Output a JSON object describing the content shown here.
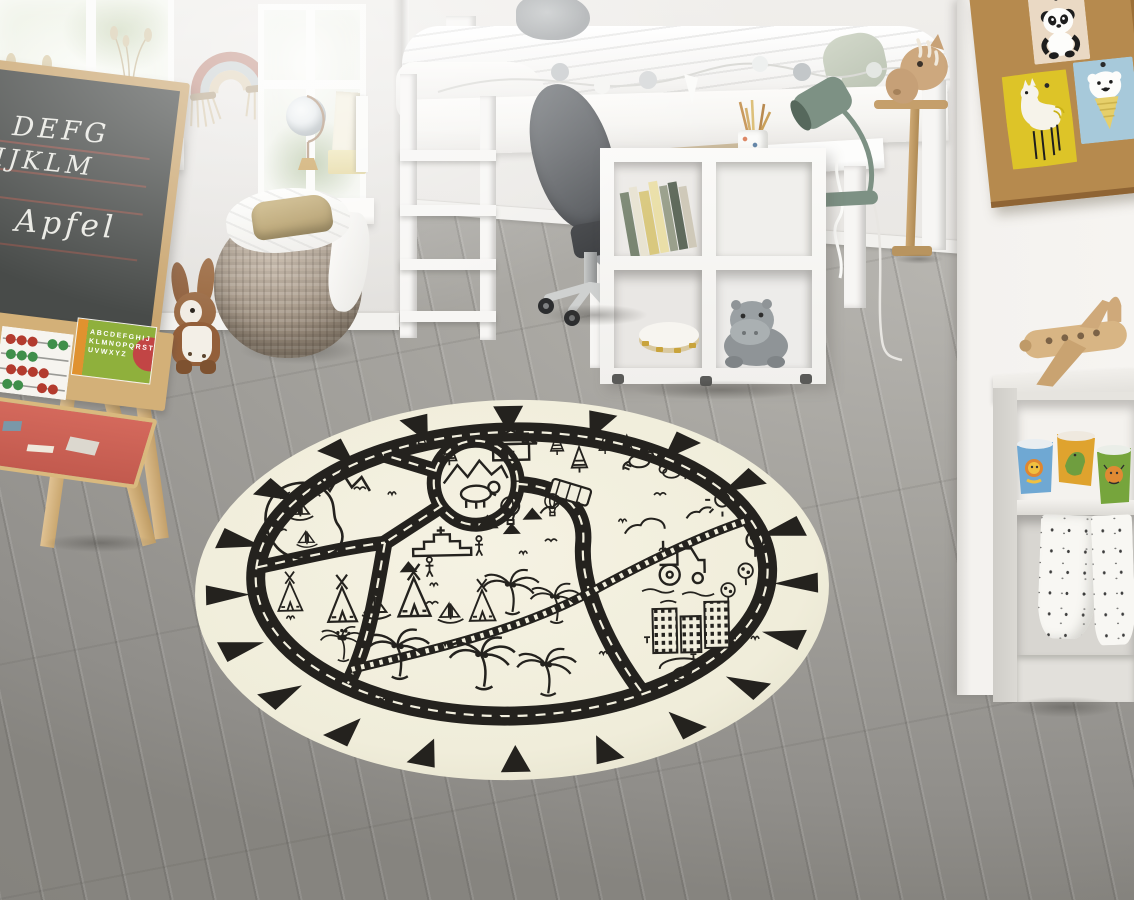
{
  "scene": {
    "setting": "Bright Scandinavian children's room with a round black-and-cream road play rug on grey wood flooring",
    "lighting": "soft daylight from windows on the left"
  },
  "chalkboard": {
    "lines": [
      "DEFG",
      "IJKLM",
      "Apfel"
    ]
  },
  "alphabet_chart": {
    "rows": [
      "ABCDEFGHIJ",
      "KLMNOPQRST",
      "UVWXYZ"
    ]
  },
  "rug": {
    "style": "round play rug, hand-drawn road map motif",
    "base_color": "#f1eedd",
    "ink_color": "#24221e",
    "motifs": [
      "triangle border",
      "ring road with dashed centerline",
      "roundabout with bear and mountains",
      "lake with sailboats",
      "mountain zigzags",
      "pine trees and cabin",
      "raccoons",
      "bus",
      "hot air balloons",
      "step pyramid",
      "teepees",
      "palm trees",
      "railway track",
      "tractor in field",
      "round trees",
      "sun and clouds",
      "city buildings",
      "spiral pond"
    ]
  },
  "objects": {
    "left": [
      "window with greenery",
      "dried-flower vase",
      "macrame rainbow",
      "chalkboard easel with abacus and alphabet chart",
      "plush bunny",
      "knitted pouf with white blanket and gold pouch"
    ],
    "center": [
      "white loft bed with bedding and pompom garland",
      "grey office chair",
      "white desk with notebooks, pencil cup and sage desk lamp",
      "white cube shelf with books, tambourine and plush hippo",
      "globe and books on windowsill"
    ],
    "right": [
      "hobby horse",
      "cork pinboard with panda, llama and ice-cream-bear cards",
      "grey cabinet with wooden toy airplane",
      "three animal cups",
      "muslin cloths with animal print"
    ]
  },
  "palette": {
    "wall": "#ece9e6",
    "floor": "#a3a19c",
    "rug_base": "#f1eedd",
    "rug_ink": "#24221e",
    "pouf": "#ab9d8d",
    "lamp_sage": "#7d9184",
    "cork": "#b68a4e",
    "card_yellow": "#ddc428",
    "card_blue": "#a7c9da",
    "card_beige": "#ead9c4",
    "wood_toy": "#d8b584",
    "chair_grey": "#5f6266"
  }
}
